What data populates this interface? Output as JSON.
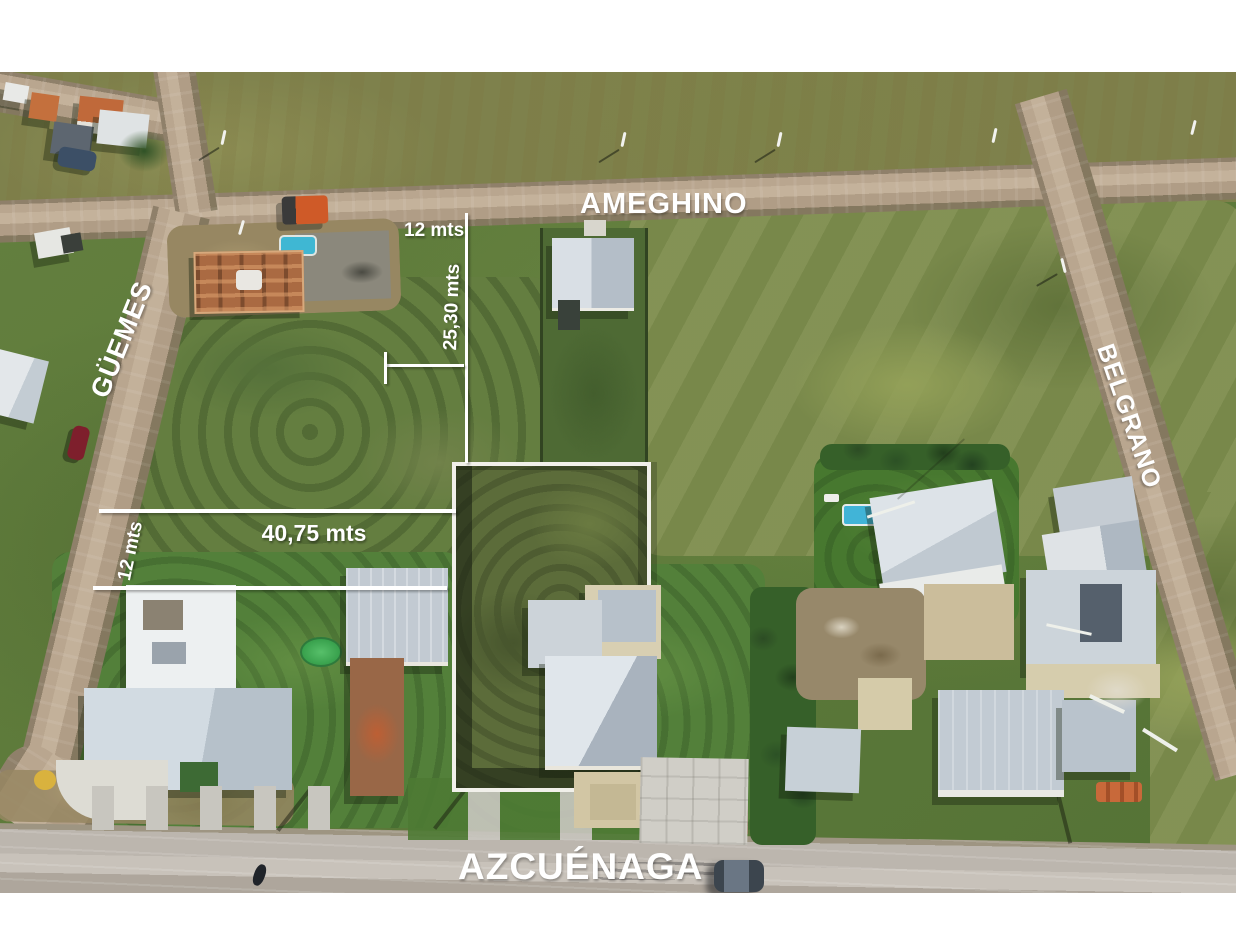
{
  "image": {
    "kind": "annotated aerial drone photo of land lots for sale",
    "streets": {
      "top": "AMEGHINO",
      "left": "GÜEMES",
      "right": "BELGRANO",
      "bottom": "AZCUÉNAGA"
    },
    "measurements": {
      "lot_front_top": "12 mts",
      "lot_depth_top": "25,30 mts",
      "lot_length_side": "40,75 mts",
      "lot_width_side": "12 mts"
    },
    "colors": {
      "annotation_text": "#ffffff",
      "measure_line": "#ffffff",
      "field_top_olive": "#7e814c",
      "field_main_green": "#5d7a3a",
      "meadow_light": "#78884a",
      "dirt_road": "#b9a68f",
      "paved_road": "#bcb6ae",
      "lot_wall_white": "#f1f0ea",
      "lot_grass": "#5c6c3a",
      "roof_gray": "#c4ccd4",
      "roof_white": "#edf0f2",
      "brick_orange": "#b5653f",
      "pool_blue": "#41b4d7",
      "pool_green": "#3aa24e"
    }
  }
}
